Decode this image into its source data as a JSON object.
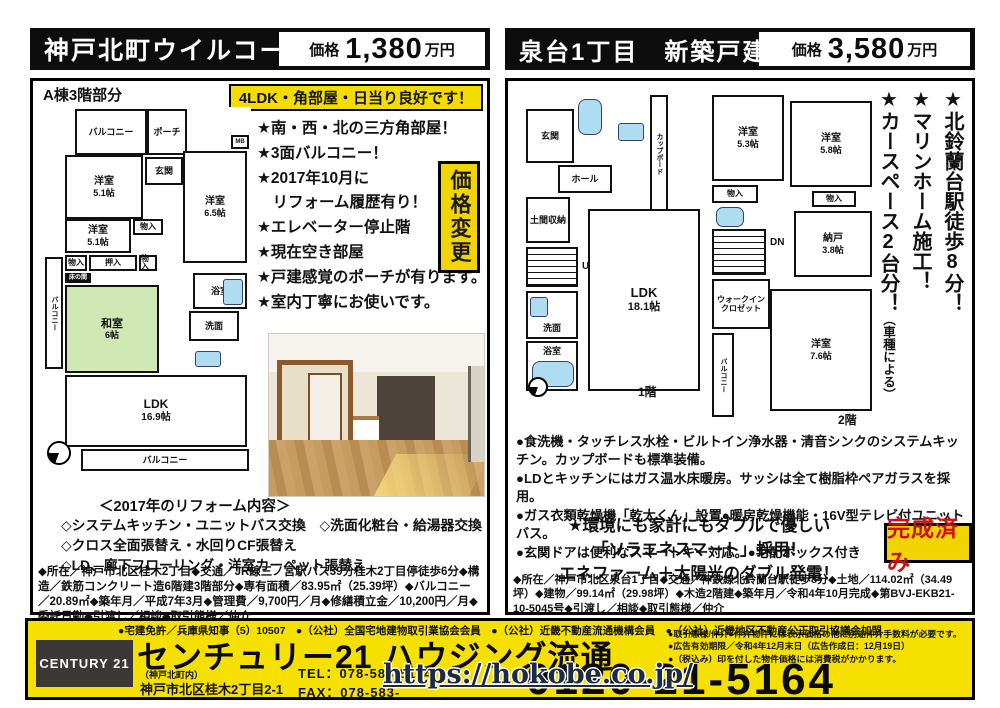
{
  "header_left": {
    "title": "神戸北町ウイルコート",
    "price_label": "価格",
    "price_value": "1,380",
    "price_unit": "万円"
  },
  "header_right": {
    "title": "泉台1丁目　新築戸建",
    "price_label": "価格",
    "price_value": "3,580",
    "price_unit": "万円"
  },
  "left": {
    "plan_caption": "A棟3階部分",
    "highlight": "4LDK・角部屋・日当り良好です！",
    "bullets": [
      "★南・西・北の三方角部屋！",
      "★3面バルコニー！",
      "★2017年10月に",
      "　リフォーム履歴有り！",
      "★エレベーター停止階",
      "★現在空き部屋",
      "★戸建感覚のポーチが有ります。",
      "★室内丁寧にお使いです。"
    ],
    "price_change_badge": "価格変更",
    "plan": {
      "balcony_top": "バルコニー",
      "porch": "ポーチ",
      "mb": "MB",
      "entrance": "玄関",
      "room_a_name": "洋室",
      "room_a_size": "5.1帖",
      "room_b_name": "洋室",
      "room_b_size": "6.5帖",
      "room_c_name": "洋室",
      "room_c_size": "5.1帖",
      "closet1": "物入",
      "closet2": "物入",
      "closet3": "物入",
      "oshiire": "押入",
      "tokonoma": "床の間",
      "washitsu_name": "和室",
      "washitsu_size": "6帖",
      "bath": "浴室",
      "wash": "洗面",
      "ldk_name": "LDK",
      "ldk_size": "16.9帖",
      "balcony_left": "バルコニー",
      "balcony_bottom": "バルコニー"
    },
    "reform_title": "＜2017年のリフォーム内容＞",
    "reform_lines": [
      "◇システムキッチン・ユニットバス交換　◇洗面化粧台・給湯器交換",
      "◇クロス全面張替え・水回りCF張替え",
      "◇LD、廊下フローリング・洋室カーペット張替え"
    ],
    "details": "◆所在／神戸市北区桂木2丁目◆交通／JR線三ノ宮駅バス39分桂木2丁目停徒歩6分◆構造／鉄筋コンクリート造6階建3階部分◆専有面積／83.95㎡（25.39坪）◆バルコニー／20.89㎡◆築年月／平成7年3月◆管理費／9,700円／月◆修繕積立金／10,200円／月◆委託日勤◆引渡し／相談◆取引態様／仲介"
  },
  "right": {
    "plan1f": {
      "entrance": "玄関",
      "hall": "ホール",
      "cupboard": "カップボード",
      "doma": "土間収納",
      "up": "UP",
      "wash": "洗面",
      "bath": "浴室",
      "ldk_name": "LDK",
      "ldk_size": "18.1帖",
      "floor": "1階"
    },
    "plan2f": {
      "room1_name": "洋室",
      "room1_size": "5.3帖",
      "room2_name": "洋室",
      "room2_size": "5.8帖",
      "closet1": "物入",
      "closet2": "物入",
      "dn": "DN",
      "nando_name": "納戸",
      "nando_size": "3.8帖",
      "wic": "ウォークインクロゼット",
      "balcony": "バルコニー",
      "room3_name": "洋室",
      "room3_size": "7.6帖",
      "floor": "2階"
    },
    "catch": [
      "★北鈴蘭台駅徒歩8分！",
      "★マリンホーム施工！",
      "★カースペース2台分！"
    ],
    "catch_note": "（車種による）",
    "bullets": [
      "●食洗機・タッチレス水栓・ビルトイン浄水器・清音シンクのシステムキッチン。カップボードも標準装備。",
      "●LDとキッチンにはガス温水床暖房。サッシは全て樹脂枠ペアガラスを採用。",
      "●ガス衣類乾燥機「乾太くん」設置●暖房乾燥機能・16V型テレビ付ユニットバス。",
      "●玄関ドアは便利なスマートキー対応。●宅配ボックス付き"
    ],
    "eco_lines": [
      "★環境にも家計にもダブルで優しい",
      "「ソラエネスマート」採用！",
      "エネファーム＋太陽光のダブル発電！"
    ],
    "completed_badge": "完成済み",
    "details": "◆所在／神戸市北区泉台1丁目◆交通／神鉄線北鈴蘭台駅徒歩8分◆土地／114.02㎡（34.49坪）◆建物／99.14㎡（29.98坪）◆木造2階建◆築年月／令和4年10月完成◆第BVJ-EKB21-10-5045号◆引渡し／相談◆取引態様／仲介"
  },
  "footer": {
    "license": "●宅建免許／兵庫県知事（5）10507　●（公社）全国宅地建物取引業協会会員　●（公社）近畿不動産流通機構会員　●（公社）近畿地区不動産公正取引協議会加盟",
    "logo": "CENTURY 21",
    "company": "センチュリー21 ハウジング流通",
    "branch": "（神戸北町内）",
    "address": "神戸市北区桂木2丁目2-1",
    "tel": "TEL：078-583-5164",
    "fax": "FAX：078-583-",
    "notes": [
      "●取引態様/仲介●仲介物件には表示価格の他に別途仲介手数料が必要です。",
      "●広告有効期限／令和4年12月末日（広告作成日：12月19日）",
      "●（税込み）印を付した物件価格には消費税がかかります。"
    ],
    "freedial": "0120-21-5164"
  },
  "watermark": "https://hokobe.co.jp/"
}
